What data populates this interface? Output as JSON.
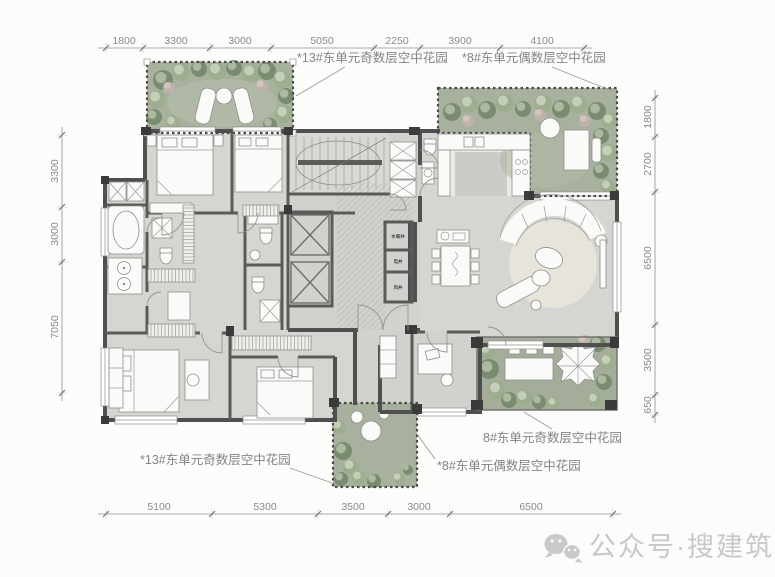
{
  "plan": {
    "labels": {
      "top_left": "*13#东单元奇数层空中花园",
      "top_right": "*8#东单元偶数层空中花园",
      "right_bottom": "8#东单元奇数层空中花园",
      "bottom_center": "*8#东单元偶数层空中花园",
      "bottom_left": "*13#东单元奇数层空中花园"
    },
    "shafts": [
      "水暖井",
      "电井",
      "风井"
    ],
    "dimensions": {
      "top": [
        "1800",
        "3300",
        "3000",
        "5050",
        "2250",
        "3900",
        "4100"
      ],
      "bottom": [
        "5100",
        "5300",
        "3500",
        "3000",
        "6500"
      ],
      "left": [
        "3300",
        "3000",
        "7050"
      ],
      "right": [
        "1800",
        "2700",
        "6500",
        "3500",
        "650"
      ]
    },
    "watermark": {
      "text": "公众号·搜建筑",
      "icon": "wechat-icon"
    },
    "colors": {
      "garden": "#a7b19d",
      "garden_dark_tree": "#76896c",
      "garden_light_tree": "#9cae8e",
      "wall": "#4f4f4f",
      "floor": "#d4d4d1",
      "rug": "#e7e4db",
      "dim_text": "#8a8a8a",
      "watermark": "#c8c8c8"
    }
  }
}
